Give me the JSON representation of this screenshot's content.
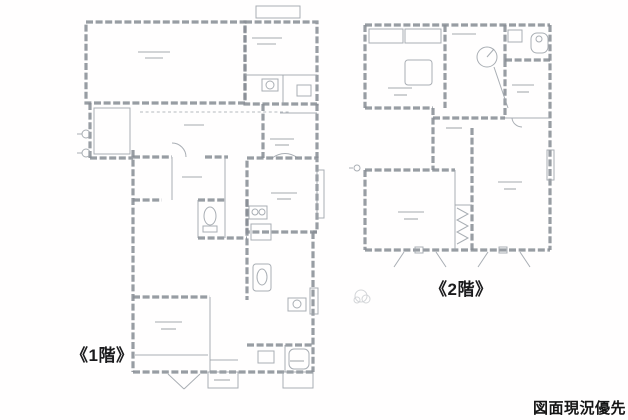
{
  "labels": {
    "floor1": "《1階》",
    "floor2": "《2階》",
    "note": "図面現況優先"
  },
  "colors": {
    "background": "#ffffff",
    "wall_line": "#82888f",
    "thin_line": "#989ea5",
    "label_text": "#1b1b1d"
  }
}
